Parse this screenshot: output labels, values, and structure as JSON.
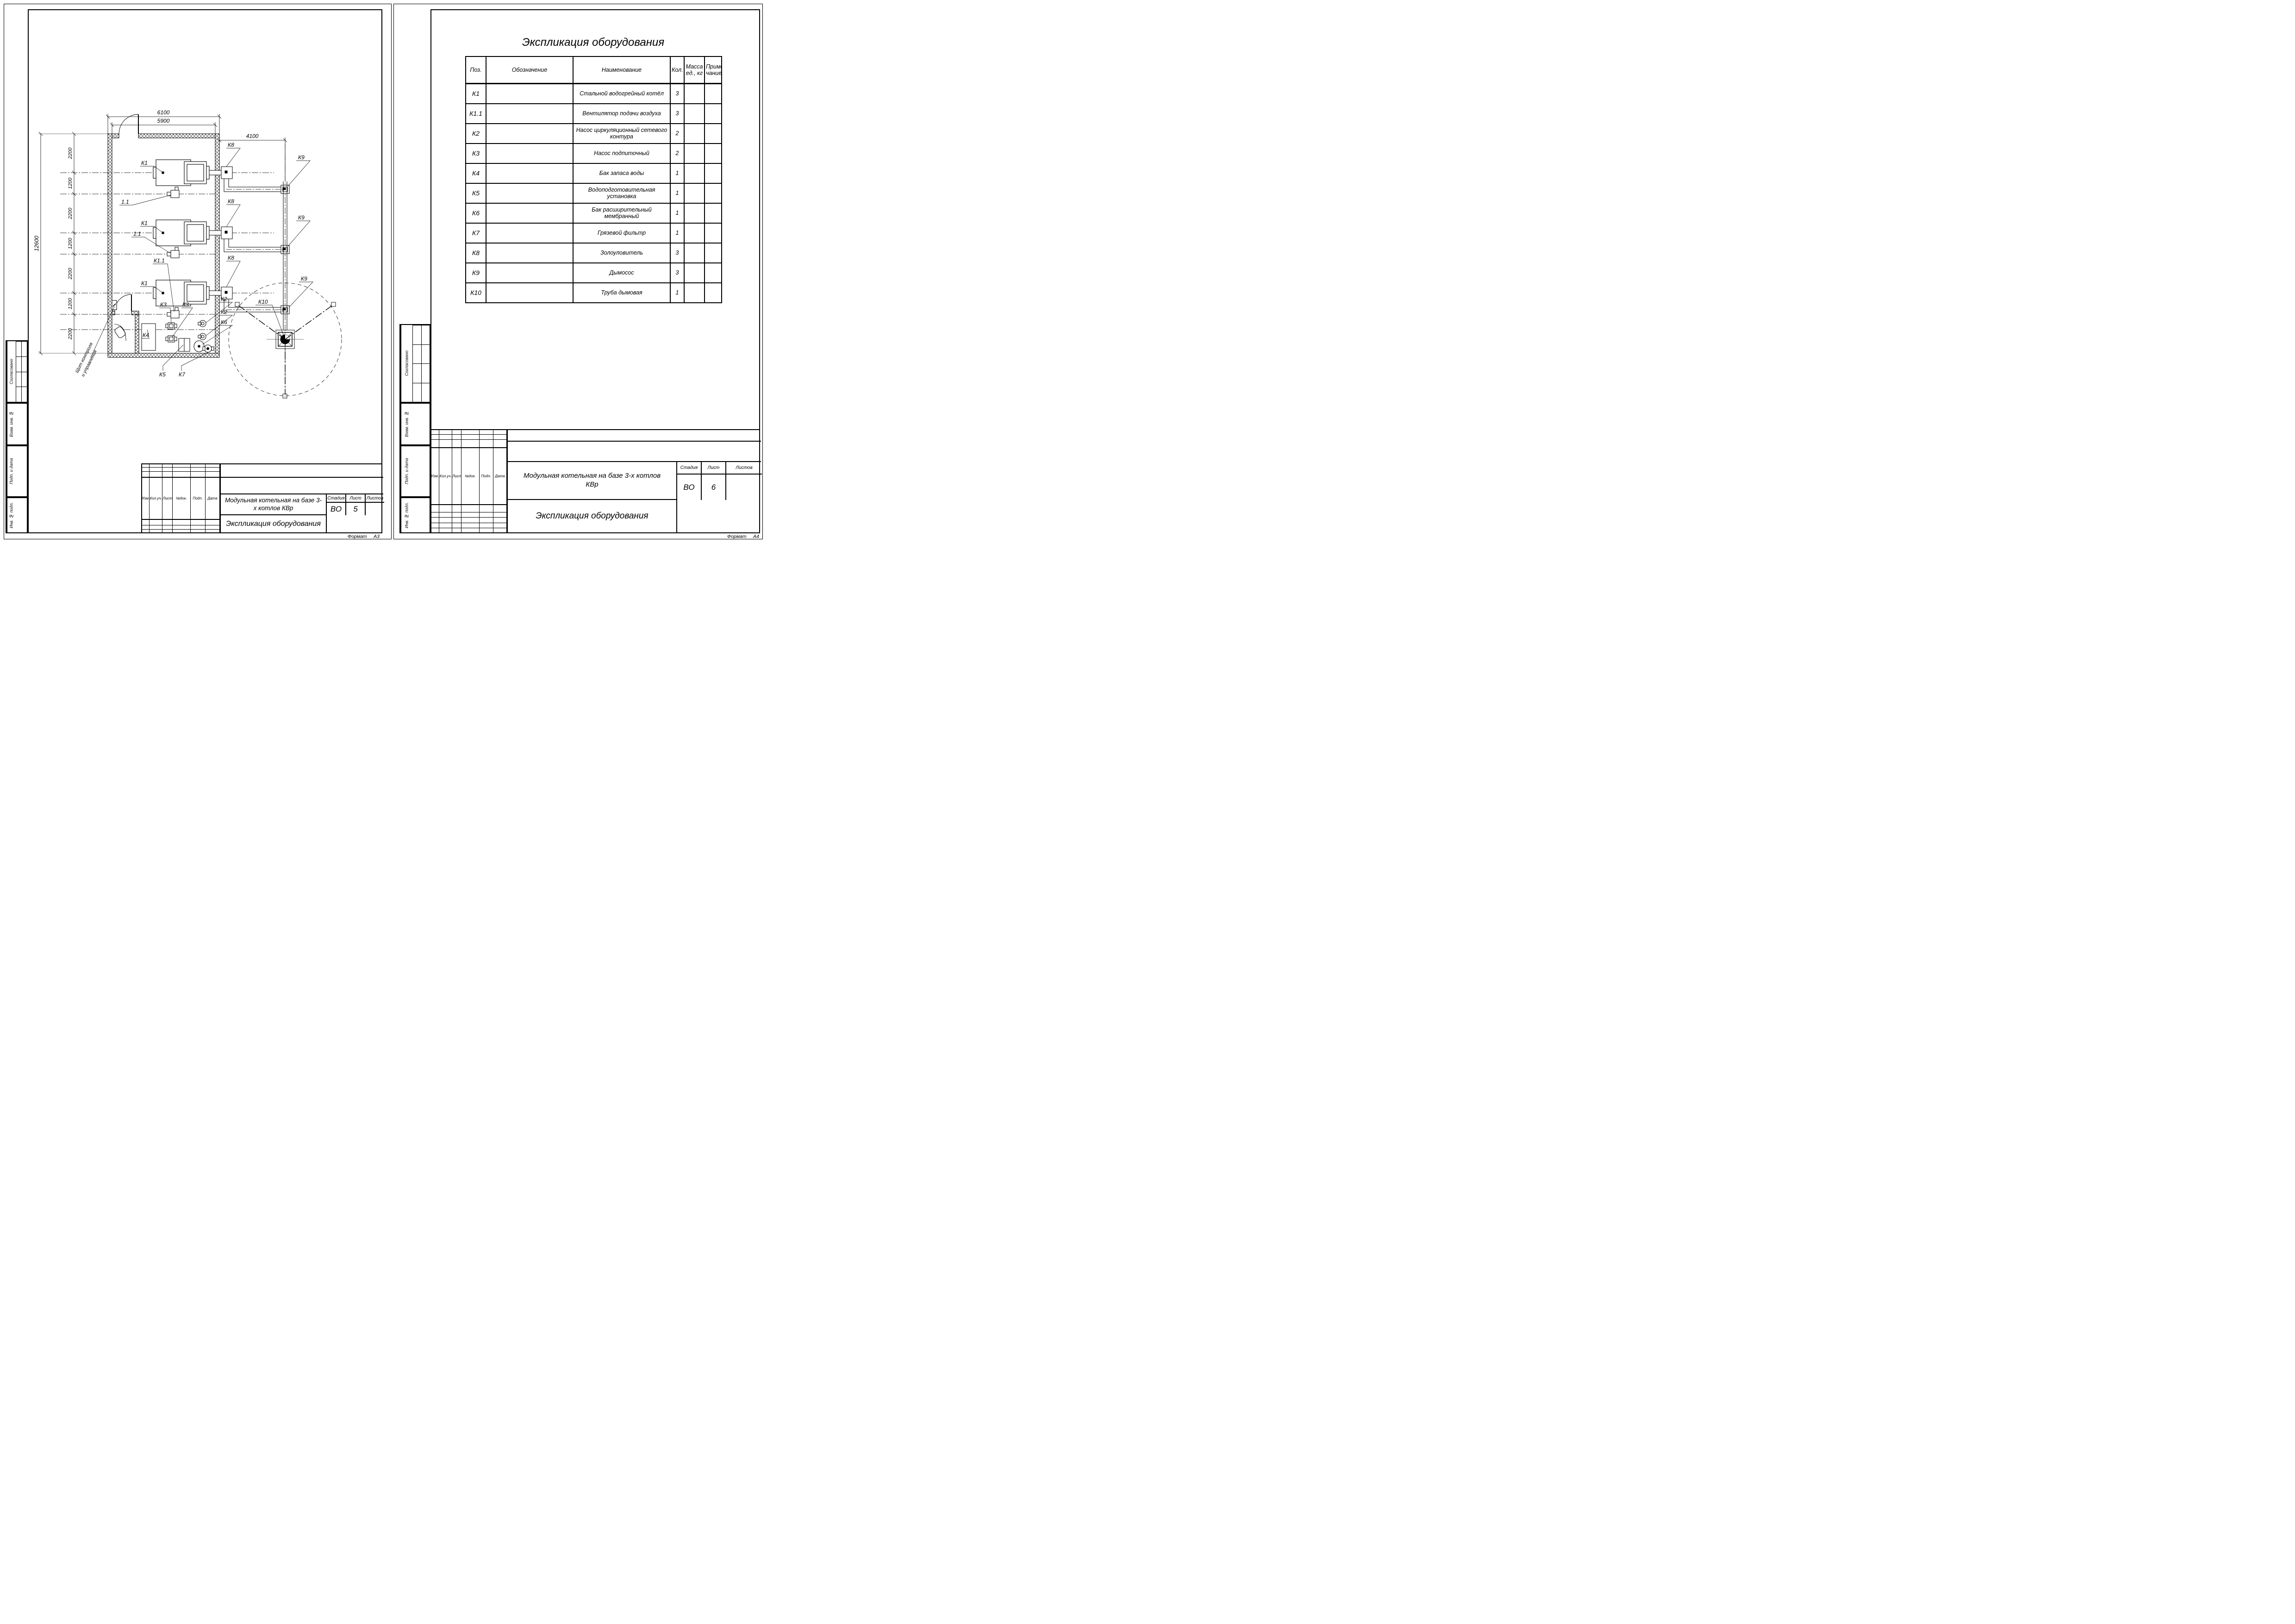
{
  "left_sheet": {
    "format_label": "Формат",
    "format_value": "А3",
    "plan": {
      "dim_top_outer": "6100",
      "dim_top_inner": "5900",
      "dim_right": "4100",
      "dim_total": "12600",
      "chain": [
        "2200",
        "1200",
        "2200",
        "1200",
        "2200",
        "1200",
        "2200"
      ],
      "labels": {
        "k1": "К1",
        "fan": "1.1",
        "k1_1": "К1.1",
        "k2": "К2",
        "k3": "К3",
        "k4": "К4",
        "k5": "К5",
        "k6": "К6",
        "k7": "К7",
        "k8": "К8",
        "k9": "К9",
        "k10": "К10",
        "control_panel_line1": "Щит контроля",
        "control_panel_line2": "и управления"
      }
    },
    "title_block": {
      "columns": [
        "Изм.",
        "Кол.уч.",
        "Лист",
        "№док.",
        "Подп.",
        "Дата"
      ],
      "project": "Модульная котельная на базе 3-х котлов КВр",
      "doc": "Экспликация оборудования",
      "stage_label": "Стадия",
      "sheet_label": "Лист",
      "sheets_label": "Листов",
      "stage": "ВО",
      "sheet": "5",
      "sheets": ""
    }
  },
  "right_sheet": {
    "format_label": "Формат",
    "format_value": "А4",
    "table_title": "Экспликация оборудования",
    "table": {
      "headers": {
        "pos": "Поз.",
        "designation": "Обозначение",
        "name": "Наименование",
        "qty": "Кол.",
        "mass": "Масса ед., кг",
        "note": "Приме-чание"
      },
      "rows": [
        {
          "pos": "К1",
          "designation": "",
          "name": "Стальной водогрейный котёл",
          "qty": "3",
          "mass": "",
          "note": ""
        },
        {
          "pos": "К1.1",
          "designation": "",
          "name": "Вентилятор подачи воздуха",
          "qty": "3",
          "mass": "",
          "note": ""
        },
        {
          "pos": "К2",
          "designation": "",
          "name": "Насос циркуляционный сетевого контура",
          "qty": "2",
          "mass": "",
          "note": ""
        },
        {
          "pos": "К3",
          "designation": "",
          "name": "Насос подпиточный",
          "qty": "2",
          "mass": "",
          "note": ""
        },
        {
          "pos": "К4",
          "designation": "",
          "name": "Бак запаса воды",
          "qty": "1",
          "mass": "",
          "note": ""
        },
        {
          "pos": "К5",
          "designation": "",
          "name": "Водоподготовительная установка",
          "qty": "1",
          "mass": "",
          "note": ""
        },
        {
          "pos": "К6",
          "designation": "",
          "name": "Бак расширительный мембранный",
          "qty": "1",
          "mass": "",
          "note": ""
        },
        {
          "pos": "К7",
          "designation": "",
          "name": "Грязевой фильтр",
          "qty": "1",
          "mass": "",
          "note": ""
        },
        {
          "pos": "К8",
          "designation": "",
          "name": "Золоуловитель",
          "qty": "3",
          "mass": "",
          "note": ""
        },
        {
          "pos": "К9",
          "designation": "",
          "name": "Дымосос",
          "qty": "3",
          "mass": "",
          "note": ""
        },
        {
          "pos": "К10",
          "designation": "",
          "name": "Труба дымовая",
          "qty": "1",
          "mass": "",
          "note": ""
        }
      ]
    },
    "title_block": {
      "columns": [
        "Изм.",
        "Кол.уч.",
        "Лист",
        "№док.",
        "Подп.",
        "Дата"
      ],
      "project": "Модульная котельная на базе 3-х котлов КВр",
      "doc": "Экспликация оборудования",
      "stage_label": "Стадия",
      "sheet_label": "Лист",
      "sheets_label": "Листов",
      "stage": "ВО",
      "sheet": "6",
      "sheets": ""
    }
  },
  "side_strip": {
    "agreed": "Согласовано",
    "replace_inv": "Взам. инв. №",
    "sign_date": "Подп. и дата",
    "inv_num": "Инв. № подл."
  }
}
